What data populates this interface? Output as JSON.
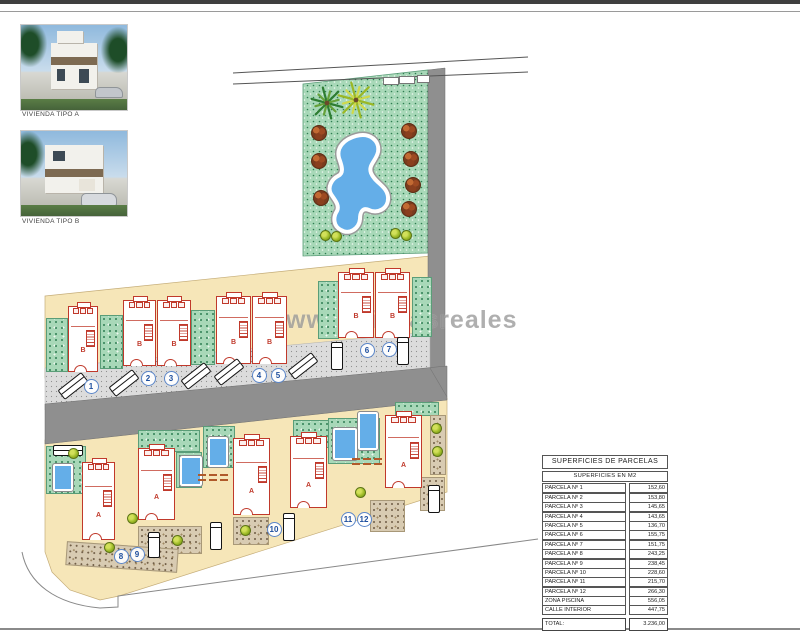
{
  "legend_images": [
    {
      "label": "VIVIENDA TIPO A",
      "type": "A"
    },
    {
      "label": "VIVIENDA TIPO B",
      "type": "B"
    }
  ],
  "watermark": "www.civitasreales",
  "table": {
    "title": "SUPERFICIES DE PARCELAS",
    "subtitle": "SUPERFICIES EN M2",
    "rows": [
      {
        "label": "PARCELA Nº 1",
        "value": "152,60"
      },
      {
        "label": "PARCELA Nº 2",
        "value": "153,80"
      },
      {
        "label": "PARCELA Nº 3",
        "value": "145,65"
      },
      {
        "label": "PARCELA Nº 4",
        "value": "143,65"
      },
      {
        "label": "PARCELA Nº 5",
        "value": "136,70"
      },
      {
        "label": "PARCELA Nº 6",
        "value": "155,75"
      },
      {
        "label": "PARCELA Nº 7",
        "value": "151,75"
      },
      {
        "label": "PARCELA Nº 8",
        "value": "243,25"
      },
      {
        "label": "PARCELA Nº 9",
        "value": "238,45"
      },
      {
        "label": "PARCELA Nº 10",
        "value": "228,60"
      },
      {
        "label": "PARCELA Nº 11",
        "value": "215,70"
      },
      {
        "label": "PARCELA Nº 12",
        "value": "266,30"
      },
      {
        "label": "ZONA PISCINA",
        "value": "556,05"
      },
      {
        "label": "CALLE INTERIOR",
        "value": "447,75"
      }
    ],
    "total_label": "TOTAL:",
    "total_value": "3.236,00"
  },
  "site_plan": {
    "colors": {
      "tan": "#f6e6b8",
      "green": "#a8d8b8",
      "road": "#8f8f8f",
      "pool_blue": "#64aee8",
      "house_red": "#c0392b",
      "number_blue": "#1d4e9e"
    },
    "houses": [
      {
        "n": 1,
        "type": "B",
        "x": 68,
        "y": 306,
        "w": 30,
        "h": 66
      },
      {
        "n": 2,
        "type": "B",
        "x": 123,
        "y": 300,
        "w": 33,
        "h": 66
      },
      {
        "n": 3,
        "type": "B",
        "x": 157,
        "y": 300,
        "w": 34,
        "h": 66
      },
      {
        "n": 4,
        "type": "B",
        "x": 216,
        "y": 296,
        "w": 35,
        "h": 68
      },
      {
        "n": 5,
        "type": "B",
        "x": 252,
        "y": 296,
        "w": 35,
        "h": 68
      },
      {
        "n": 6,
        "type": "B",
        "x": 338,
        "y": 272,
        "w": 36,
        "h": 66
      },
      {
        "n": 7,
        "type": "B",
        "x": 375,
        "y": 272,
        "w": 35,
        "h": 66
      },
      {
        "n": 8,
        "type": "A",
        "x": 82,
        "y": 462,
        "w": 33,
        "h": 78
      },
      {
        "n": 9,
        "type": "A",
        "x": 138,
        "y": 448,
        "w": 37,
        "h": 72
      },
      {
        "n": 10,
        "type": "A",
        "x": 233,
        "y": 438,
        "w": 37,
        "h": 77
      },
      {
        "n": 11,
        "type": "A",
        "x": 290,
        "y": 436,
        "w": 37,
        "h": 72
      },
      {
        "n": 12,
        "type": "A",
        "x": 385,
        "y": 415,
        "w": 37,
        "h": 73
      }
    ],
    "plot_numbers": [
      {
        "n": "1",
        "x": 90,
        "y": 385
      },
      {
        "n": "2",
        "x": 147,
        "y": 377
      },
      {
        "n": "3",
        "x": 170,
        "y": 377
      },
      {
        "n": "4",
        "x": 258,
        "y": 374
      },
      {
        "n": "5",
        "x": 277,
        "y": 374
      },
      {
        "n": "6",
        "x": 366,
        "y": 349
      },
      {
        "n": "7",
        "x": 388,
        "y": 348
      },
      {
        "n": "8",
        "x": 120,
        "y": 555
      },
      {
        "n": "9",
        "x": 136,
        "y": 553
      },
      {
        "n": "10",
        "x": 273,
        "y": 528
      },
      {
        "n": "11",
        "x": 347,
        "y": 518
      },
      {
        "n": "12",
        "x": 363,
        "y": 518
      }
    ],
    "cars": [
      {
        "x": 58,
        "y": 380,
        "w": 30,
        "h": 12,
        "r": -38
      },
      {
        "x": 109,
        "y": 377,
        "w": 30,
        "h": 12,
        "r": -38
      },
      {
        "x": 181,
        "y": 370,
        "w": 30,
        "h": 12,
        "r": -38
      },
      {
        "x": 214,
        "y": 366,
        "w": 30,
        "h": 12,
        "r": -38
      },
      {
        "x": 288,
        "y": 360,
        "w": 30,
        "h": 12,
        "r": -38
      },
      {
        "x": 331,
        "y": 342,
        "w": 12,
        "h": 28,
        "r": 0
      },
      {
        "x": 397,
        "y": 337,
        "w": 12,
        "h": 28,
        "r": 0
      },
      {
        "x": 53,
        "y": 445,
        "w": 30,
        "h": 11,
        "r": 0
      },
      {
        "x": 148,
        "y": 532,
        "w": 12,
        "h": 26,
        "r": 0
      },
      {
        "x": 210,
        "y": 522,
        "w": 12,
        "h": 28,
        "r": 0
      },
      {
        "x": 283,
        "y": 513,
        "w": 12,
        "h": 28,
        "r": 0
      },
      {
        "x": 428,
        "y": 485,
        "w": 12,
        "h": 28,
        "r": 0
      }
    ],
    "gardens": [
      {
        "x": 46,
        "y": 318,
        "w": 20,
        "h": 52
      },
      {
        "x": 100,
        "y": 315,
        "w": 21,
        "h": 52
      },
      {
        "x": 191,
        "y": 310,
        "w": 22,
        "h": 53
      },
      {
        "x": 318,
        "y": 281,
        "w": 19,
        "h": 56
      },
      {
        "x": 412,
        "y": 277,
        "w": 18,
        "h": 58
      },
      {
        "x": 46,
        "y": 446,
        "w": 38,
        "h": 46
      },
      {
        "x": 138,
        "y": 430,
        "w": 60,
        "h": 20
      },
      {
        "x": 176,
        "y": 452,
        "w": 24,
        "h": 34
      },
      {
        "x": 203,
        "y": 426,
        "w": 30,
        "h": 40
      },
      {
        "x": 293,
        "y": 420,
        "w": 34,
        "h": 26
      },
      {
        "x": 328,
        "y": 418,
        "w": 50,
        "h": 44
      },
      {
        "x": 395,
        "y": 402,
        "w": 42,
        "h": 12
      }
    ],
    "pools": [
      {
        "x": 53,
        "y": 464,
        "w": 16,
        "h": 23
      },
      {
        "x": 180,
        "y": 456,
        "w": 18,
        "h": 26
      },
      {
        "x": 208,
        "y": 437,
        "w": 16,
        "h": 26
      },
      {
        "x": 333,
        "y": 428,
        "w": 20,
        "h": 28
      },
      {
        "x": 358,
        "y": 412,
        "w": 16,
        "h": 34
      }
    ],
    "driveways": [
      {
        "x": 138,
        "y": 526,
        "w": 62,
        "h": 26,
        "r": 0
      },
      {
        "x": 233,
        "y": 517,
        "w": 34,
        "h": 26,
        "r": 0
      },
      {
        "x": 370,
        "y": 500,
        "w": 33,
        "h": 30,
        "r": 0
      },
      {
        "x": 420,
        "y": 477,
        "w": 23,
        "h": 32,
        "r": 0
      },
      {
        "x": 66,
        "y": 545,
        "w": 110,
        "h": 22,
        "r": 4
      },
      {
        "x": 430,
        "y": 415,
        "w": 14,
        "h": 58,
        "r": 0
      }
    ],
    "brown_bushes": [
      [
        318,
        132
      ],
      [
        318,
        160
      ],
      [
        320,
        197
      ],
      [
        408,
        130
      ],
      [
        410,
        158
      ],
      [
        412,
        184
      ],
      [
        408,
        208
      ]
    ],
    "small_bushes": [
      [
        324,
        234
      ],
      [
        335,
        235
      ],
      [
        394,
        232
      ],
      [
        405,
        234
      ],
      [
        72,
        452
      ],
      [
        108,
        546
      ],
      [
        131,
        517
      ],
      [
        176,
        539
      ],
      [
        244,
        529
      ],
      [
        359,
        491
      ],
      [
        435,
        427
      ],
      [
        436,
        450
      ]
    ],
    "white_rects": [
      [
        383,
        77,
        14,
        6
      ],
      [
        399,
        76,
        14,
        6
      ],
      [
        417,
        75,
        11,
        6
      ]
    ],
    "palms": [
      {
        "x": 327,
        "y": 103,
        "r": 16,
        "c1": "#2e7d32",
        "c2": "#66a13a"
      },
      {
        "x": 356,
        "y": 100,
        "r": 18,
        "c1": "#9ab825",
        "c2": "#cfd94a"
      }
    ],
    "dash_groups": [
      [
        198,
        474
      ],
      [
        352,
        458
      ]
    ]
  }
}
